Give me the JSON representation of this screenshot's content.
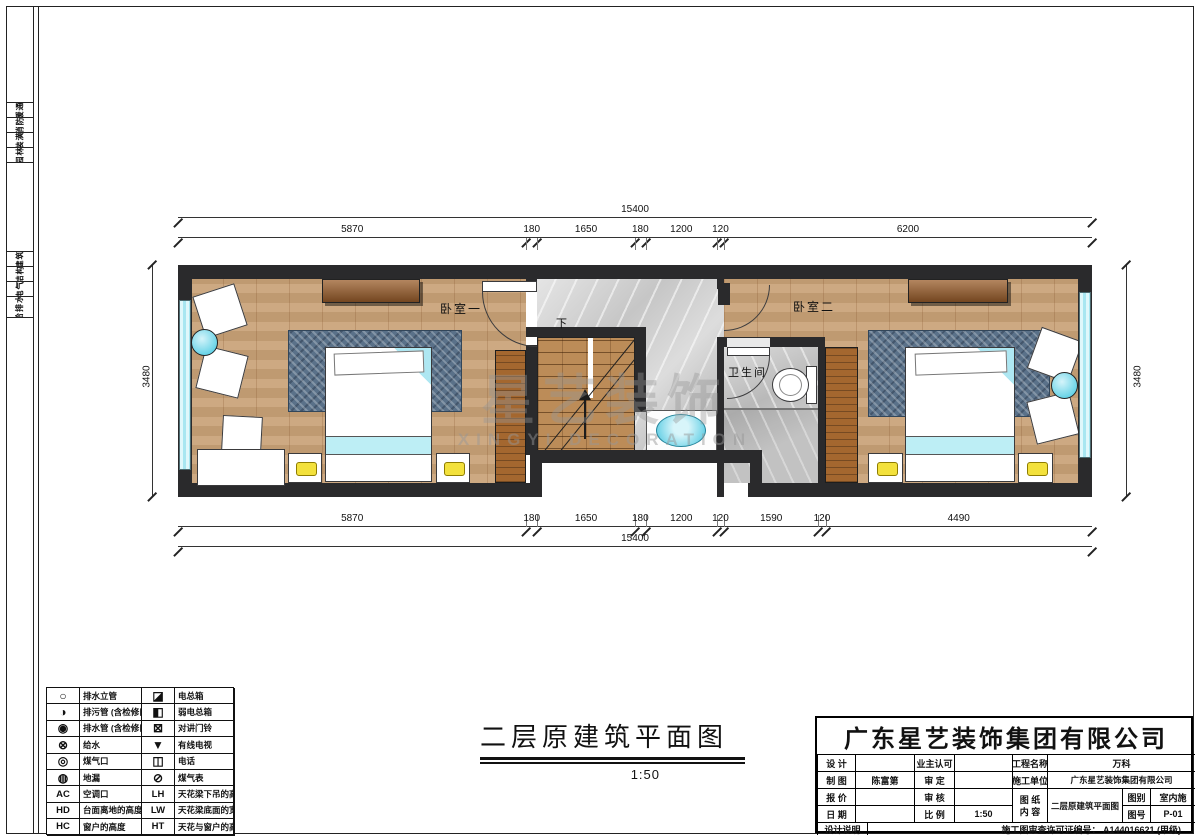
{
  "sheet": {
    "discipline_strip": {
      "upper": [
        "暖通",
        "消防",
        "装潢",
        "园林"
      ],
      "lower": [
        "建筑",
        "结构",
        "电气",
        "给排水"
      ]
    }
  },
  "plan": {
    "rooms": {
      "bedroom1": "卧室一",
      "bedroom2": "卧室二",
      "bathroom": "卫生间",
      "stairs_down": "下"
    },
    "watermark": {
      "cn": "星艺装饰",
      "en": "XINGYI DECORATION"
    }
  },
  "dimensions": {
    "top_total": [
      15400
    ],
    "top_segments": [
      5870,
      180,
      1650,
      180,
      1200,
      120,
      6200
    ],
    "bottom_segments": [
      5870,
      180,
      1650,
      180,
      1200,
      120,
      1590,
      120,
      4490
    ],
    "bottom_total": [
      15400
    ],
    "left_side": "3480",
    "right_side": "3480"
  },
  "drawing_title": {
    "text": "二层原建筑平面图",
    "scale": "1:50"
  },
  "legend": {
    "rows": [
      {
        "s1": "○",
        "t1": "排水立管",
        "s2": "◪",
        "t2": "电总箱"
      },
      {
        "s1": "◑",
        "t1": "排污管 (含检修口)",
        "s2": "◧",
        "t2": "弱电总箱"
      },
      {
        "s1": "◉",
        "t1": "排水管 (含检修口)",
        "s2": "⊠",
        "t2": "对讲门铃"
      },
      {
        "s1": "⊗",
        "t1": "给水",
        "s2": "▼",
        "t2": "有线电视"
      },
      {
        "s1": "◎",
        "t1": "煤气口",
        "s2": "◫",
        "t2": "电话"
      },
      {
        "s1": "◍",
        "t1": "地漏",
        "s2": "⊘",
        "t2": "煤气表"
      },
      {
        "s1": "AC",
        "t1": "空调口",
        "s2": "LH",
        "t2": "天花梁下吊的高度"
      },
      {
        "s1": "HD",
        "t1": "台面离地的高度",
        "s2": "LW",
        "t2": "天花梁底面的宽度"
      },
      {
        "s1": "HC",
        "t1": "窗户的高度",
        "s2": "HT",
        "t2": "天花与窗户的高度"
      }
    ]
  },
  "title_block": {
    "company": "广东星艺装饰集团有限公司",
    "fields": {
      "design_label": "设 计",
      "design_value": "",
      "owner_label": "业主认可",
      "owner_value": "",
      "project_label": "工程名称",
      "project_value": "万科",
      "draft_label": "制 图",
      "draft_value": "陈富第",
      "approve_label": "审 定",
      "approve_value": "",
      "builder_label": "施工单位",
      "builder_value": "广东星艺装饰集团有限公司",
      "quote_label": "报 价",
      "quote_value": "",
      "check_label": "审 核",
      "check_value": "",
      "sheet_label_1": "图 纸",
      "sheet_label_2": "内 容",
      "sheet_value": "二层原建筑平面图",
      "category_label": "图别",
      "category_value": "室内施",
      "number_label": "图号",
      "number_value": "P-01",
      "date_label": "日 期",
      "date_value": "",
      "scale_label": "比 例",
      "scale_value": "1:50",
      "notes_label": "设计说明",
      "permit_text": "施工图审查许可证编号：  A144016621 (甲级)"
    }
  }
}
